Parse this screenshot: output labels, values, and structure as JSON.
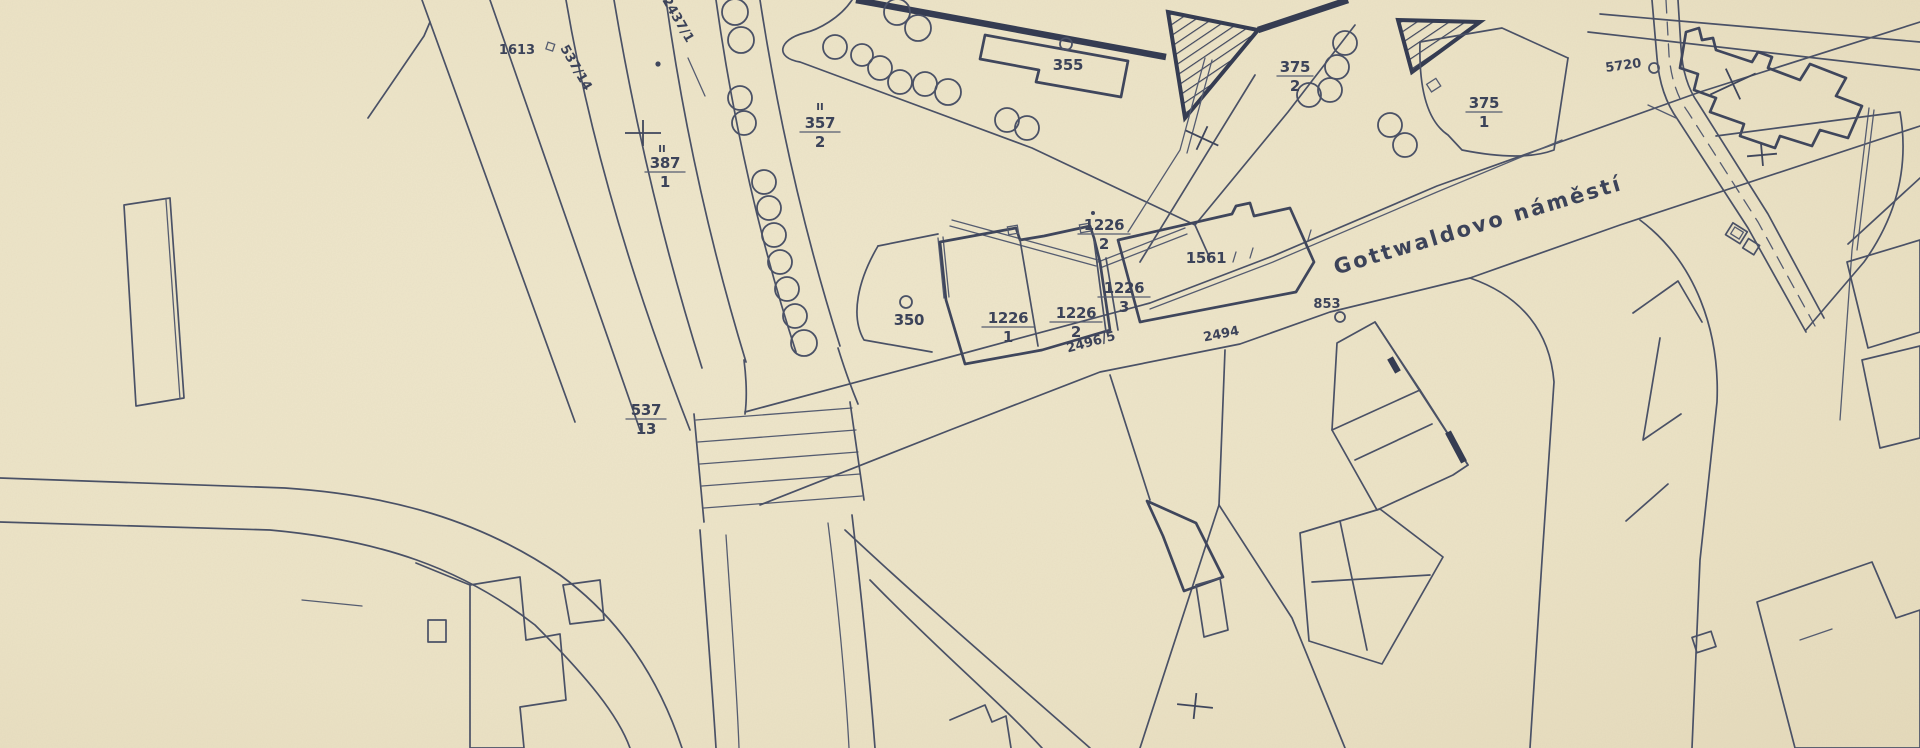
{
  "meta": {
    "kind": "scanned cadastral plan",
    "colors": {
      "paper": "#ece3c6",
      "ink": "#4a5166",
      "ink_dark": "#3a4157"
    }
  },
  "street": {
    "name": "Gottwaldovo náměstí"
  },
  "labels": {
    "p1613": "1613",
    "p537_14": "537/14",
    "p2437_1": "2437/1",
    "p355": "355",
    "p350": "350",
    "p1561": "1561",
    "p2496_5": "2496/5",
    "p2494": "2494",
    "p853": "853",
    "p5720": "5720",
    "mark_a": "II",
    "mark_b": "II"
  },
  "fractions": {
    "f387_1": {
      "num": "387",
      "den": "1"
    },
    "f357_2": {
      "num": "357",
      "den": "2"
    },
    "f375_2": {
      "num": "375",
      "den": "2"
    },
    "f375_1": {
      "num": "375",
      "den": "1"
    },
    "f1226_2a": {
      "num": "1226",
      "den": "2"
    },
    "f1226_3": {
      "num": "1226",
      "den": "3"
    },
    "f1226_1": {
      "num": "1226",
      "den": "1"
    },
    "f1226_2b": {
      "num": "1226",
      "den": "2"
    },
    "f537_13": {
      "num": "537",
      "den": "13"
    }
  }
}
